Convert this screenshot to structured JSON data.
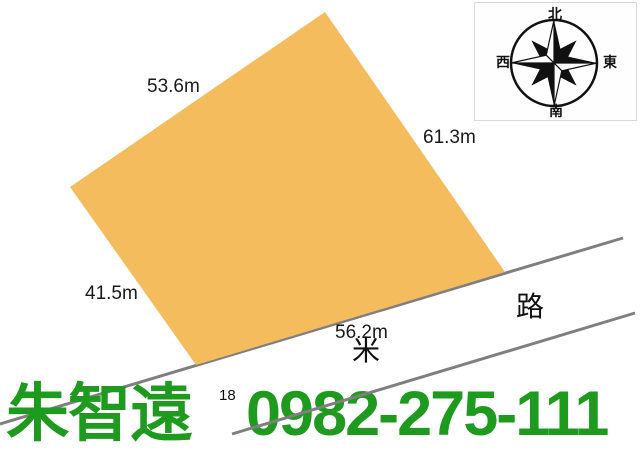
{
  "page": {
    "background_color": "#ffffff"
  },
  "parcel": {
    "fill_color": "#f5bc5e",
    "stroke_color": "#6e665a",
    "side_lengths": {
      "top_left": "53.6m",
      "top_right": "61.3m",
      "bottom_left": "41.5m",
      "bottom_right": "56.2m"
    }
  },
  "road": {
    "line_color": "#7f7f7f",
    "name_label": "路",
    "unit_label": "米",
    "width_label": "18"
  },
  "compass": {
    "north_label": "北",
    "south_label": "南",
    "east_label": "東",
    "west_label": "西"
  },
  "contact": {
    "name": "朱智遠",
    "phone": "0982-275-111",
    "text_color": "#1e9b1e"
  }
}
